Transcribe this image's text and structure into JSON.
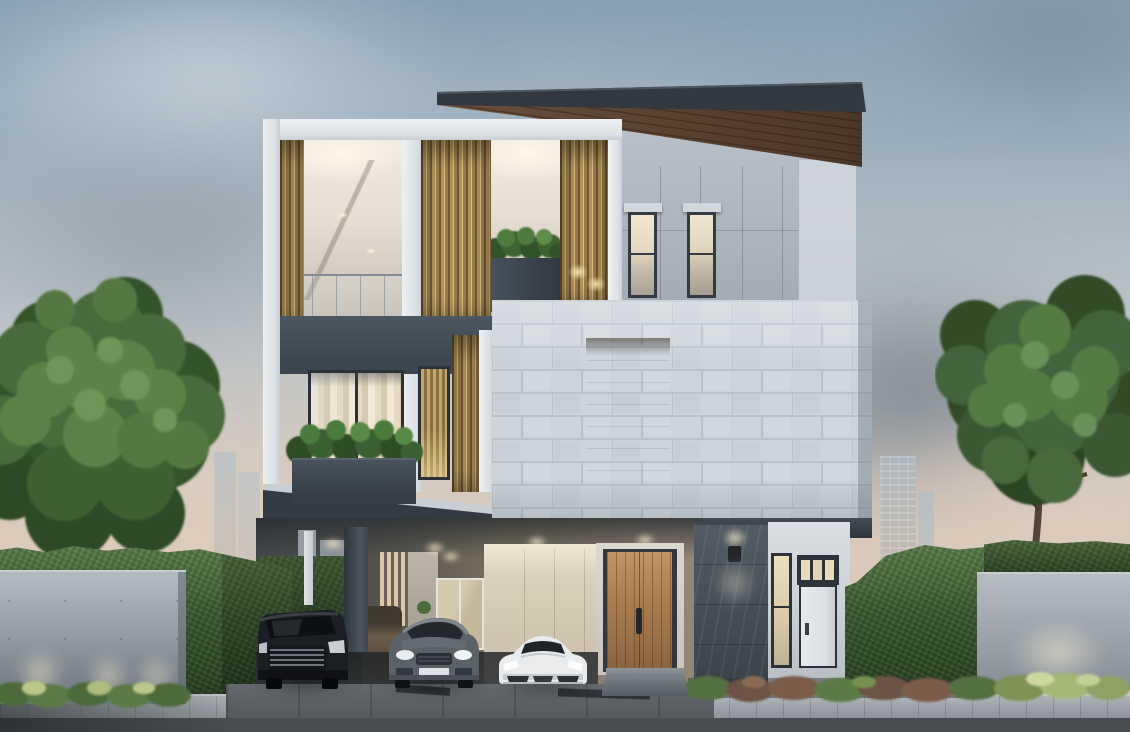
{
  "image": {
    "kind": "photorealistic architectural rendering",
    "description": "Modern three-storey luxury house at dusk: brass louvred balconies, white running-bond brick feature volume with warm lit niche, charcoal flat roof with timber soffit, carport sheltering three cars, timber front door, slate accent wall with sconce, concrete boundary walls with uplights, tall hedges, two large trees and a hazy city skyline",
    "time_of_day": "dusk",
    "width_px": 1130,
    "height_px": 732
  },
  "labels": {
    "stage": "dusk exterior rendering of a modern three-storey house",
    "house": "three-storey modern house with carport",
    "vehicles": "three parked cars under the carport",
    "landscape": "hedges, trees, concrete fence walls and planting",
    "sky": "dusk sky with soft grey clouds",
    "ground": "driveway, pale paver sidewalk and asphalt road"
  },
  "sky": {
    "top_color": "#8aa0b2",
    "mid_color": "#bcc3c8",
    "horizon_color": "#dccbbc",
    "clouds": "soft grey cumulus with warm glow near horizon"
  },
  "skyline": {
    "left_towers": 2,
    "carport_gap_towers": 2,
    "right_towers": 2,
    "color": "#b3bcc4"
  },
  "house": {
    "storeys": 3,
    "roof": {
      "fascia_color": "#31383f",
      "soffit_material": "timber planks",
      "soffit_color": "#5d4736"
    },
    "upper_wall": {
      "color": "#b4bbc3",
      "narrow_windows": 2,
      "window_glow": "warm",
      "window_hoods": 2
    },
    "frame_color": "#e7eaec",
    "louvres": {
      "material": "brass",
      "color": "#b39458",
      "panels": 4
    },
    "balconies": {
      "count": 2,
      "ceiling": "warm white with recessed downlights",
      "balustrade": "glass with slim rails",
      "spandrel_color": "#47515b",
      "roof_planter": "dark box with green shrubs"
    },
    "level2": {
      "window": "full-height, sheer curtains, warm light",
      "planter": "dark box with lush green shrubs",
      "narrow_window": "brass louvres behind glass"
    },
    "brick_volume": {
      "color": "#ccd3d9",
      "bond": "running",
      "niche_light": "warm recessed glow"
    },
    "carport": {
      "ceiling_downlights": 5,
      "back_wall": "cream panels",
      "glazed_lobby": true,
      "column_color": "#3a4147",
      "white_post": true
    },
    "front_door": {
      "material": "timber planks",
      "color": "#a97c4f",
      "handle": "dark vertical pull",
      "steps": 2
    },
    "slate_wall": {
      "color": "#4b545c",
      "sconce": "up/down wall light"
    },
    "side_entry": {
      "door_color": "#e2e6e9",
      "transom_panes": 3,
      "tall_window": "warm lit"
    }
  },
  "vehicles": [
    {
      "type": "luxury minivan",
      "color": "black",
      "position": "left bay",
      "detail": "chrome mesh grille"
    },
    {
      "type": "SUV",
      "color": "grey",
      "position": "middle bay",
      "detail": "lit headlights, white licence plate"
    },
    {
      "type": "sports car",
      "color": "white",
      "position": "right bay",
      "detail": "low wedge profile, lit headlights"
    },
    {
      "type": "partially hidden car",
      "color": "bronze",
      "position": "behind carport column",
      "detail": "sliver visible"
    }
  ],
  "landscape": {
    "left_tree": {
      "size": "large",
      "foliage_color": "#46633a"
    },
    "right_tree": {
      "size": "large",
      "foliage_color": "#3a5730",
      "trunk_visible": true
    },
    "hedges": {
      "color": "#3b5830",
      "locations": "left boundary, behind carport, right boundary"
    },
    "concrete_walls": {
      "left": true,
      "right": true,
      "color": "#a9b0b7",
      "uplights": true
    },
    "shrub_borders": {
      "left": "uplit green",
      "right": "red-brown and uplit green"
    }
  },
  "ground": {
    "sidewalk": "pale granite pavers",
    "driveway": "concrete with drainage strips",
    "road": "dark asphalt"
  },
  "palette": {
    "sky_top": "#8aa0b2",
    "warm_horizon": "#dccbbc",
    "brass": "#b39458",
    "timber": "#5d4736",
    "charcoal": "#343b43",
    "white_frame": "#e7eaec",
    "brick": "#ccd3d9",
    "hedge": "#3b5830",
    "tree_green": "#46633a",
    "asphalt": "#4b4f53",
    "warm_light": "#f3e3bd"
  }
}
